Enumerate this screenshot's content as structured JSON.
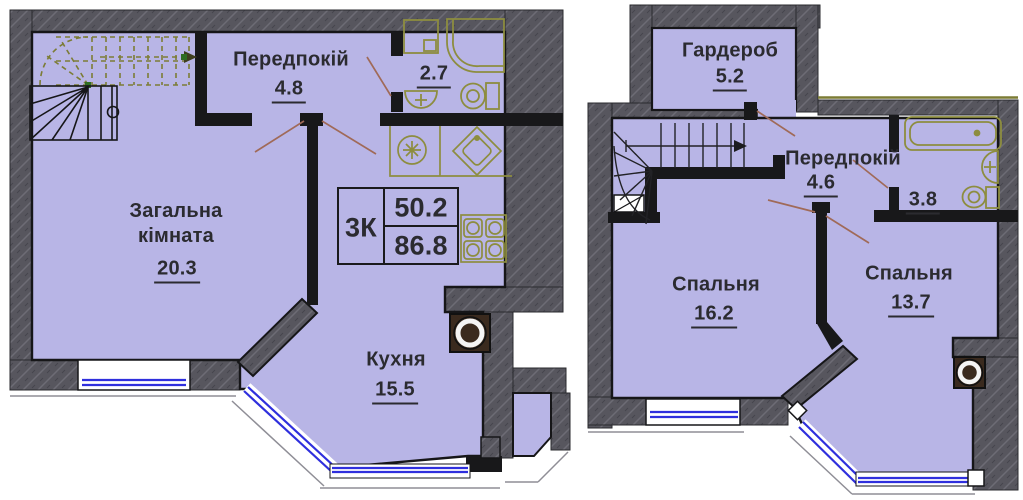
{
  "canvas": {
    "width": 1023,
    "height": 500
  },
  "colors": {
    "room_fill": "#b8b5e6",
    "wall": "#57565e",
    "partition": "#18181a",
    "fixture_outline": "#8d8d3f",
    "window_glass": "#2f2fdd",
    "leader_line": "#a06a58",
    "stair_dash": "#7c7c35",
    "vent_shaft": "#3a2a1e",
    "label_text": "#2b2b30"
  },
  "left_plan": {
    "rooms": [
      {
        "name": "Передпокій",
        "area": "4.8"
      },
      {
        "name": "",
        "area": "2.7"
      },
      {
        "name": "Загальна кімната",
        "area": "20.3"
      },
      {
        "name": "Кухня",
        "area": "15.5"
      }
    ],
    "info_box": {
      "type": "3К",
      "upper_area": "50.2",
      "lower_area": "86.8"
    }
  },
  "right_plan": {
    "rooms": [
      {
        "name": "Гардероб",
        "area": "5.2"
      },
      {
        "name": "Передпокій",
        "area": "4.6"
      },
      {
        "name": "",
        "area": "3.8"
      },
      {
        "name": "Спальня",
        "area": "16.2"
      },
      {
        "name": "Спальня",
        "area": "13.7"
      }
    ]
  }
}
